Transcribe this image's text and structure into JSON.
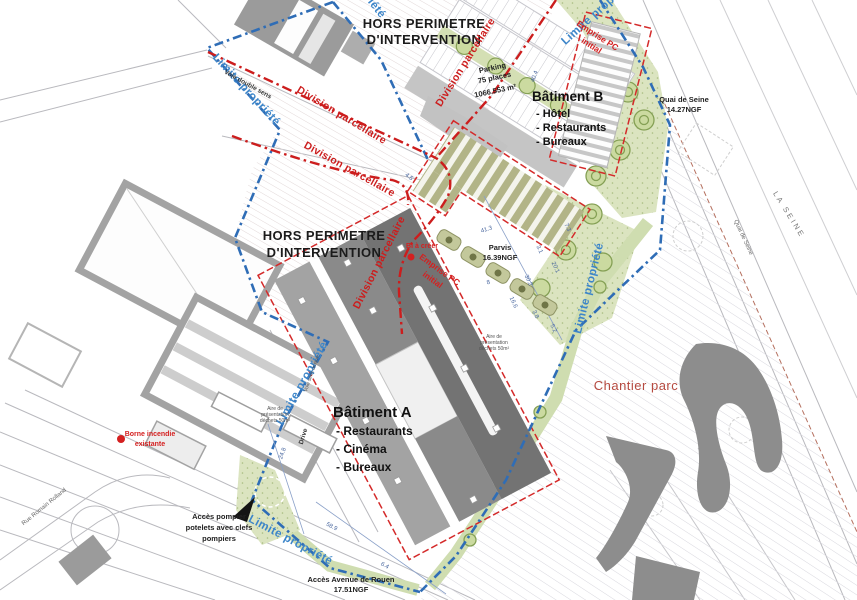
{
  "zones": {
    "hors_perimetre": {
      "line1": "HORS PERIMETRE",
      "line2": "D'INTERVENTION"
    }
  },
  "boundaries": {
    "limite_propriete": "Limite propriété",
    "division_parcellaire": "Division parcellaire",
    "emprise_line1": "Emprise PC",
    "emprise_line2": "initial"
  },
  "buildings": {
    "batiment_a": {
      "title": "Bâtiment A",
      "items": [
        "- Restaurants",
        "- Cinéma",
        "- Bureaux"
      ]
    },
    "batiment_b": {
      "title": "Bâtiment B",
      "items": [
        "- Hôtel",
        "- Restaurants",
        "- Bureaux"
      ]
    }
  },
  "annotations": {
    "bi_a_creer": "BI à créer",
    "borne_line1": "Borne incendie",
    "borne_line2": "existante",
    "chantier_parc": "Chantier parc",
    "pompier_line1": "Accès pompier",
    "pompier_line2": "potelets avec clefs",
    "pompier_line3": "pompiers",
    "acces_avenue_line1": "Accès Avenue de Rouen",
    "acces_avenue_line2": "17.51NGF",
    "parvis_line1": "Parvis",
    "parvis_line2": "16.39NGF",
    "parking_line1": "Parking",
    "parking_line2": "75 places",
    "parking_area": "1066.553 m²",
    "quai_line1": "Quai de Seine",
    "quai_line2": "14.27NGF",
    "voie_double_sens": "Voie double sens",
    "voie_sens_unique": "Voie sens unique",
    "drive": "Drive",
    "aire_line1": "Aire de",
    "aire_line2": "présentation",
    "aire_line3": "déchets 50m²"
  },
  "streets": {
    "rue_romain_rolland": "Rue Romain Rolland",
    "la_seine": "LA SEINE",
    "quai_de_seine": "Quai de Seine"
  },
  "dimensions": [
    "40.4",
    "41.3",
    "7.3",
    "3.1",
    "20.1",
    "30.2",
    "8",
    "16.6",
    "3.8",
    "5.2",
    "24.8",
    "58.9",
    "4.5",
    "6.4"
  ],
  "colors": {
    "property_line": "#2f6db6",
    "property_label": "#3c85c9",
    "division_line": "#cc1d1d",
    "annotation_red": "#d42020",
    "chantier_label": "#b5493f",
    "dimension_blue": "#49679f",
    "green_area": "#dbe4c0",
    "building_dark": "#747474",
    "building_olive": "#b2b487"
  }
}
